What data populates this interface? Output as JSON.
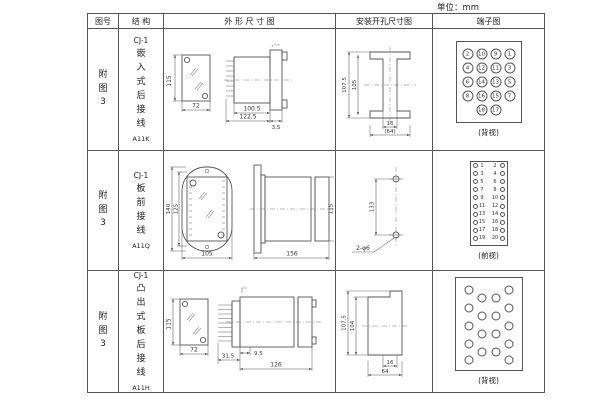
{
  "unit_label": "单位：mm",
  "header": {
    "figure": "图号",
    "structure": "结 构",
    "outline": "外 形 尺 寸 图",
    "install": "安装开孔尺寸图",
    "terminal": "端子图"
  },
  "rows": [
    {
      "figure_no": "附图3",
      "model": "CJ-1",
      "mount": "嵌入式后接线",
      "code": "A11K",
      "outline": {
        "h": "115",
        "w": "72",
        "d1": "100.5",
        "d2": "122.5",
        "d3": "3.5"
      },
      "install": {
        "v1": "107.5",
        "v2": "105",
        "w1": "16",
        "w2": "(64)"
      },
      "terminal": {
        "style": "grid",
        "view_label": "(背视)",
        "pins": [
          {
            "n": "2",
            "x": 11,
            "y": 12
          },
          {
            "n": "10",
            "x": 25,
            "y": 12
          },
          {
            "n": "9",
            "x": 39,
            "y": 12
          },
          {
            "n": "1",
            "x": 53,
            "y": 12
          },
          {
            "n": "4",
            "x": 11,
            "y": 26
          },
          {
            "n": "12",
            "x": 25,
            "y": 26
          },
          {
            "n": "11",
            "x": 39,
            "y": 26
          },
          {
            "n": "3",
            "x": 53,
            "y": 26
          },
          {
            "n": "6",
            "x": 11,
            "y": 40
          },
          {
            "n": "14",
            "x": 25,
            "y": 40
          },
          {
            "n": "13",
            "x": 39,
            "y": 40
          },
          {
            "n": "5",
            "x": 53,
            "y": 40
          },
          {
            "n": "8",
            "x": 11,
            "y": 54
          },
          {
            "n": "16",
            "x": 25,
            "y": 54
          },
          {
            "n": "15",
            "x": 39,
            "y": 54
          },
          {
            "n": "7",
            "x": 53,
            "y": 54
          },
          {
            "n": "18",
            "x": 25,
            "y": 68
          },
          {
            "n": "17",
            "x": 39,
            "y": 68
          }
        ]
      }
    },
    {
      "figure_no": "附图3",
      "model": "CJ-1",
      "mount": "板前接线",
      "code": "A11Q",
      "outline": {
        "h1": "140",
        "h2": "125",
        "w": "105",
        "l": "156",
        "sh": "115"
      },
      "install": {
        "v1": "133",
        "holes": "2-φ6"
      },
      "terminal": {
        "style": "strip",
        "view_label": "(前视)",
        "left": [
          "1",
          "3",
          "5",
          "7",
          "9",
          "11",
          "13",
          "15",
          "17",
          "19"
        ],
        "right": [
          "2",
          "4",
          "6",
          "8",
          "10",
          "12",
          "14",
          "16",
          "18",
          "20"
        ]
      }
    },
    {
      "figure_no": "附图3",
      "model": "CJ-1",
      "mount": "凸出式板后接线",
      "code": "A11H",
      "outline": {
        "h": "115",
        "w": "72",
        "p": "31.5",
        "d1": "9.5",
        "d2": "126"
      },
      "install": {
        "v1": "107.5",
        "v2": "104",
        "w1": "16",
        "w2": "64"
      },
      "terminal": {
        "style": "pins",
        "view_label": "(背视)",
        "pins": [
          {
            "x": 13,
            "y": 12
          },
          {
            "x": 13,
            "y": 30
          },
          {
            "x": 13,
            "y": 48
          },
          {
            "x": 13,
            "y": 66
          },
          {
            "x": 13,
            "y": 82
          },
          {
            "x": 26,
            "y": 20
          },
          {
            "x": 26,
            "y": 38
          },
          {
            "x": 26,
            "y": 56
          },
          {
            "x": 26,
            "y": 74
          },
          {
            "x": 40,
            "y": 20
          },
          {
            "x": 40,
            "y": 38
          },
          {
            "x": 40,
            "y": 56
          },
          {
            "x": 40,
            "y": 74
          },
          {
            "x": 53,
            "y": 12
          },
          {
            "x": 53,
            "y": 30
          },
          {
            "x": 53,
            "y": 48
          },
          {
            "x": 53,
            "y": 66
          },
          {
            "x": 53,
            "y": 82
          }
        ]
      }
    }
  ]
}
